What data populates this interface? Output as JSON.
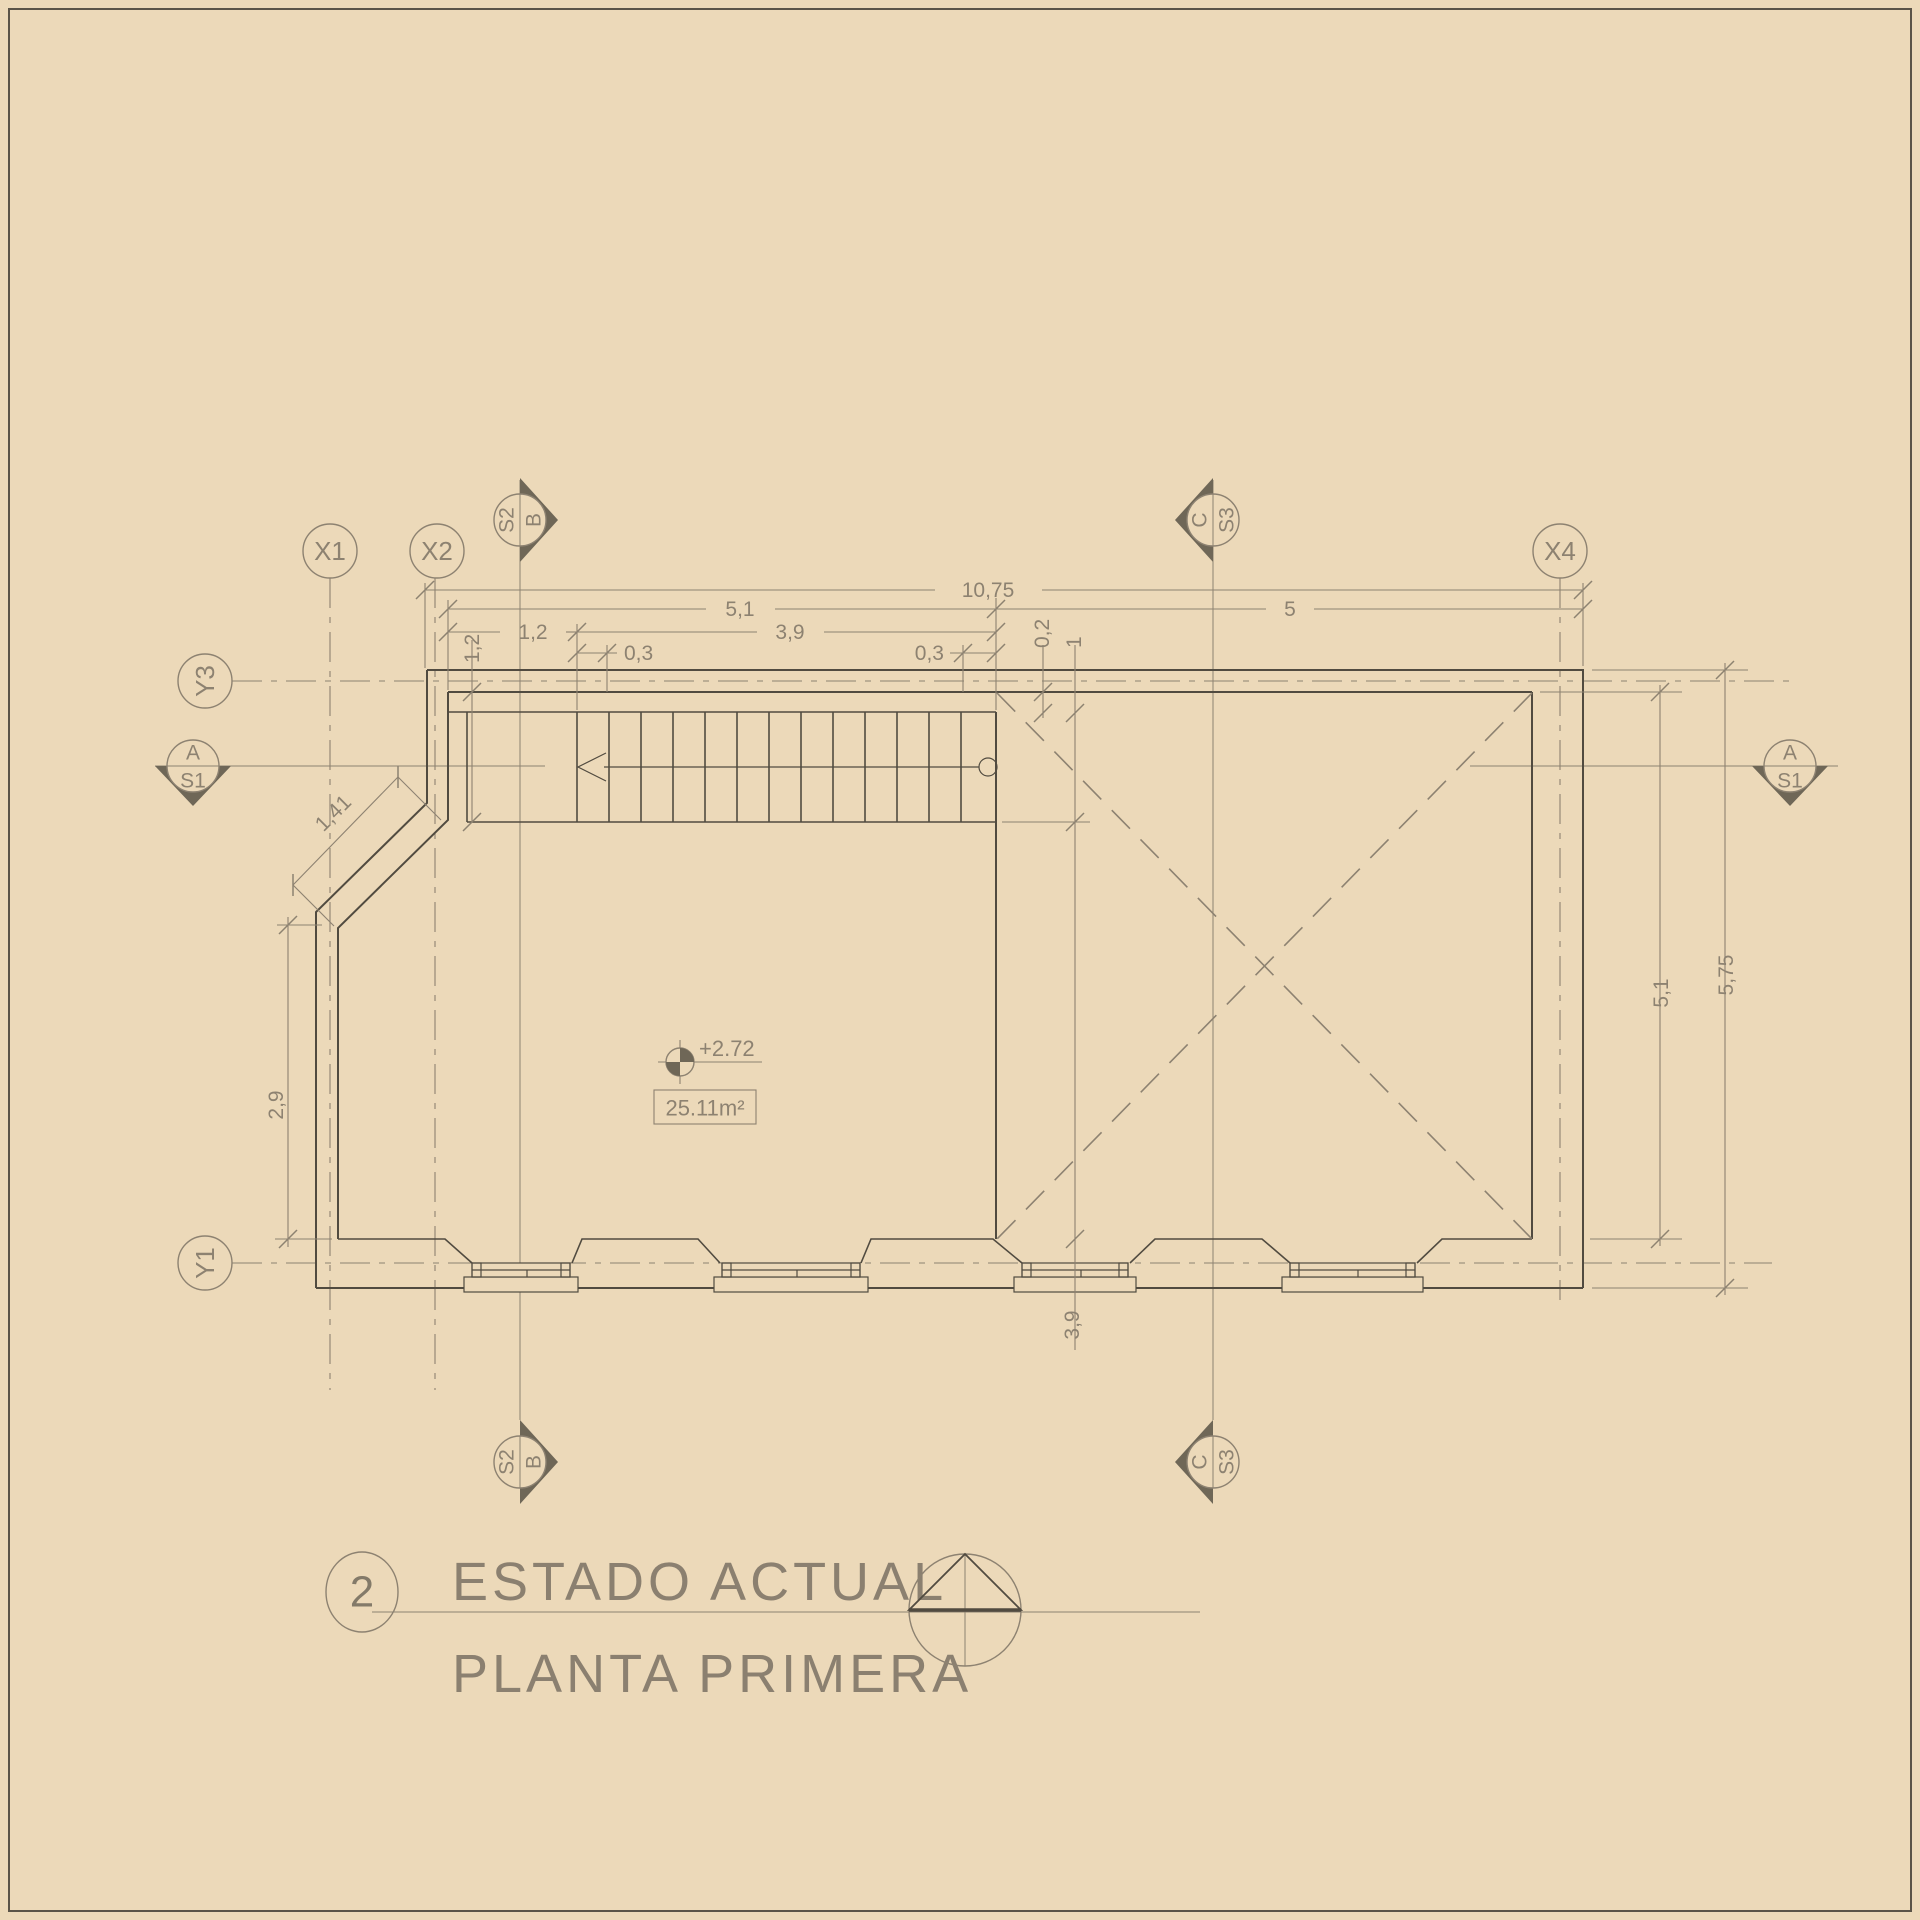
{
  "drawing": {
    "type": "architectural floor plan",
    "title": {
      "number": "2",
      "line1": "ESTADO ACTUAL",
      "line2": "PLANTA PRIMERA"
    }
  },
  "grid_markers": {
    "x1": "X1",
    "x2": "X2",
    "x4": "X4",
    "y3": "Y3",
    "y1": "Y1"
  },
  "section_markers": {
    "top_left": {
      "left": "S2",
      "right": "B"
    },
    "top_right": {
      "left": "C",
      "right": "S3"
    },
    "bottom_left": {
      "left": "S2",
      "right": "B"
    },
    "bottom_right": {
      "left": "C",
      "right": "S3"
    },
    "side_left": {
      "top": "A",
      "bottom": "S1"
    },
    "side_right": {
      "top": "A",
      "bottom": "S1"
    }
  },
  "dimensions": {
    "total_width": "10,75",
    "left_span": "5,1",
    "right_span": "5",
    "stair_run": "3,9",
    "landing": "1,2",
    "tread_left": "0,3",
    "tread_right": "0,3",
    "wall_offset": "0,2",
    "stair_width": "1",
    "stair_width_left": "1,2",
    "chamfer": "1,41",
    "left_height": "2,9",
    "mid_height": "3,9",
    "right_inner_height": "5,1",
    "right_outer_height": "5,75"
  },
  "annotations": {
    "level": "+2.72",
    "area": "25.11m²"
  },
  "colors": {
    "background": "#ecd9b9",
    "wall_line": "#514b40",
    "annotation_line": "#8d8271",
    "marker_fill": "#6f6757"
  }
}
